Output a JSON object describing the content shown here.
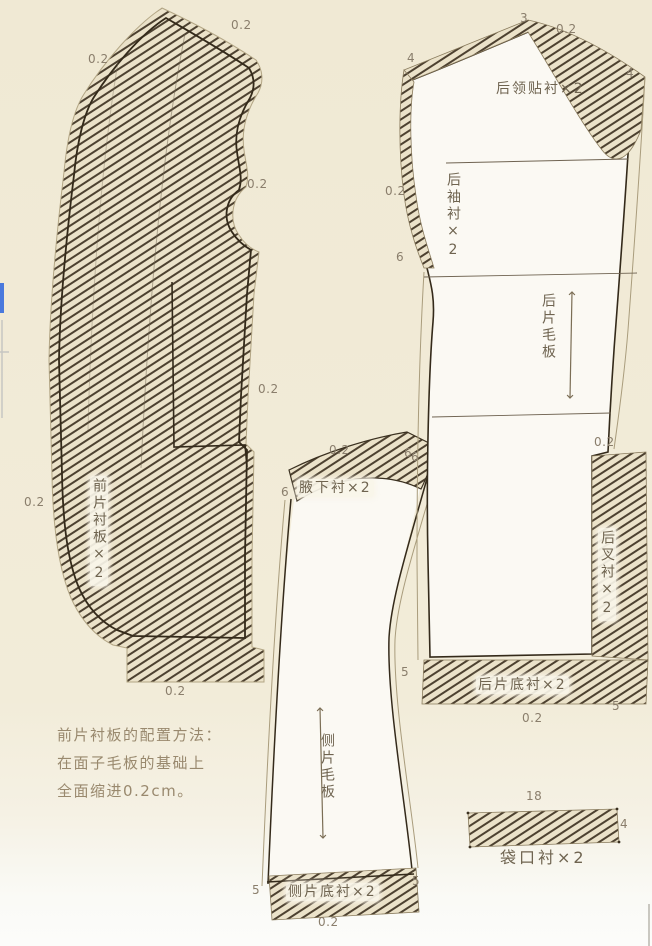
{
  "diagram": {
    "description_note": {
      "lines": [
        "前片衬板的配置方法：",
        "在面子毛板的基础上",
        "全面缩进0.2cm。"
      ]
    }
  },
  "labels": [
    {
      "name": "front-seam-02-top-left",
      "text": "0.2",
      "x": 88,
      "y": 53,
      "kind": "num"
    },
    {
      "name": "front-seam-02-top-right",
      "text": "0.2",
      "x": 231,
      "y": 19,
      "kind": "num"
    },
    {
      "name": "front-seam-02-armhole",
      "text": "0.2",
      "x": 247,
      "y": 178,
      "kind": "num"
    },
    {
      "name": "front-seam-02-right",
      "text": "0.2",
      "x": 258,
      "y": 383,
      "kind": "num"
    },
    {
      "name": "front-seam-02-left",
      "text": "0.2",
      "x": 24,
      "y": 496,
      "kind": "num"
    },
    {
      "name": "front-seam-02-bottom",
      "text": "0.2",
      "x": 165,
      "y": 685,
      "kind": "num"
    },
    {
      "name": "front-piece-label",
      "text": "前片衬板×2",
      "x": 90,
      "y": 476,
      "kind": "tagvbox"
    },
    {
      "name": "side-seam-02-top",
      "text": "0.2",
      "x": 329,
      "y": 444,
      "kind": "num"
    },
    {
      "name": "side-notch-6-left",
      "text": "6",
      "x": 281,
      "y": 486,
      "kind": "num"
    },
    {
      "name": "side-notch-6-right",
      "text": "6",
      "x": 411,
      "y": 451,
      "kind": "num"
    },
    {
      "name": "underarm-interfacing-label",
      "text": "腋下衬×2",
      "x": 297,
      "y": 479,
      "kind": "tagbox"
    },
    {
      "name": "side-piece-label",
      "text": "侧片毛板",
      "x": 320,
      "y": 733,
      "kind": "tagv"
    },
    {
      "name": "side-notch-5-left",
      "text": "5",
      "x": 252,
      "y": 884,
      "kind": "num"
    },
    {
      "name": "side-notch-5-right",
      "text": "5",
      "x": 412,
      "y": 875,
      "kind": "num"
    },
    {
      "name": "side-bottom-interfacing-label",
      "text": "侧片底衬×2",
      "x": 286,
      "y": 883,
      "kind": "tagbox"
    },
    {
      "name": "side-seam-02-bottom",
      "text": "0.2",
      "x": 318,
      "y": 916,
      "kind": "num"
    },
    {
      "name": "back-notch-3",
      "text": "3",
      "x": 520,
      "y": 12,
      "kind": "num"
    },
    {
      "name": "back-seam-02-top",
      "text": "0.2",
      "x": 556,
      "y": 23,
      "kind": "num"
    },
    {
      "name": "back-notch-4-left",
      "text": "4",
      "x": 407,
      "y": 52,
      "kind": "num"
    },
    {
      "name": "back-notch-4-right",
      "text": "4",
      "x": 626,
      "y": 67,
      "kind": "num"
    },
    {
      "name": "collar-interfacing-label",
      "text": "后领贴衬×2",
      "x": 496,
      "y": 82,
      "kind": "tag"
    },
    {
      "name": "back-seam-02-left",
      "text": "0.2",
      "x": 385,
      "y": 185,
      "kind": "num"
    },
    {
      "name": "sleeve-interfacing-label",
      "text": "后袖衬×2",
      "x": 446,
      "y": 172,
      "kind": "tagv"
    },
    {
      "name": "back-notch-6-upper",
      "text": "6",
      "x": 396,
      "y": 251,
      "kind": "num"
    },
    {
      "name": "back-piece-label",
      "text": "后片毛板",
      "x": 541,
      "y": 293,
      "kind": "tagv"
    },
    {
      "name": "back-seam-02-right",
      "text": "0.2",
      "x": 594,
      "y": 436,
      "kind": "num"
    },
    {
      "name": "back-notch-6-lower",
      "text": "6",
      "x": 404,
      "y": 447,
      "kind": "num"
    },
    {
      "name": "vent-interfacing-label",
      "text": "后叉衬×2",
      "x": 598,
      "y": 528,
      "kind": "tagvbox"
    },
    {
      "name": "back-notch-5-left",
      "text": "5",
      "x": 401,
      "y": 666,
      "kind": "num"
    },
    {
      "name": "back-bottom-interfacing-label",
      "text": "后片底衬×2",
      "x": 476,
      "y": 676,
      "kind": "tagbox"
    },
    {
      "name": "back-notch-5-right",
      "text": "5",
      "x": 612,
      "y": 700,
      "kind": "num"
    },
    {
      "name": "back-seam-02-bottom",
      "text": "0.2",
      "x": 522,
      "y": 712,
      "kind": "num"
    },
    {
      "name": "pocket-width-18",
      "text": "18",
      "x": 526,
      "y": 790,
      "kind": "num"
    },
    {
      "name": "pocket-height-4",
      "text": "4",
      "x": 620,
      "y": 818,
      "kind": "num"
    },
    {
      "name": "pocket-interfacing-label",
      "text": "袋口衬×2",
      "x": 500,
      "y": 850,
      "kind": "tagbig"
    },
    {
      "name": "note-line-1",
      "text": "前片衬板的配置方法：",
      "x": 57,
      "y": 728,
      "kind": "note"
    },
    {
      "name": "note-line-2",
      "text": "在面子毛板的基础上",
      "x": 57,
      "y": 756,
      "kind": "note"
    },
    {
      "name": "note-line-3",
      "text": "全面缩进0.2cm。",
      "x": 57,
      "y": 784,
      "kind": "note"
    }
  ]
}
